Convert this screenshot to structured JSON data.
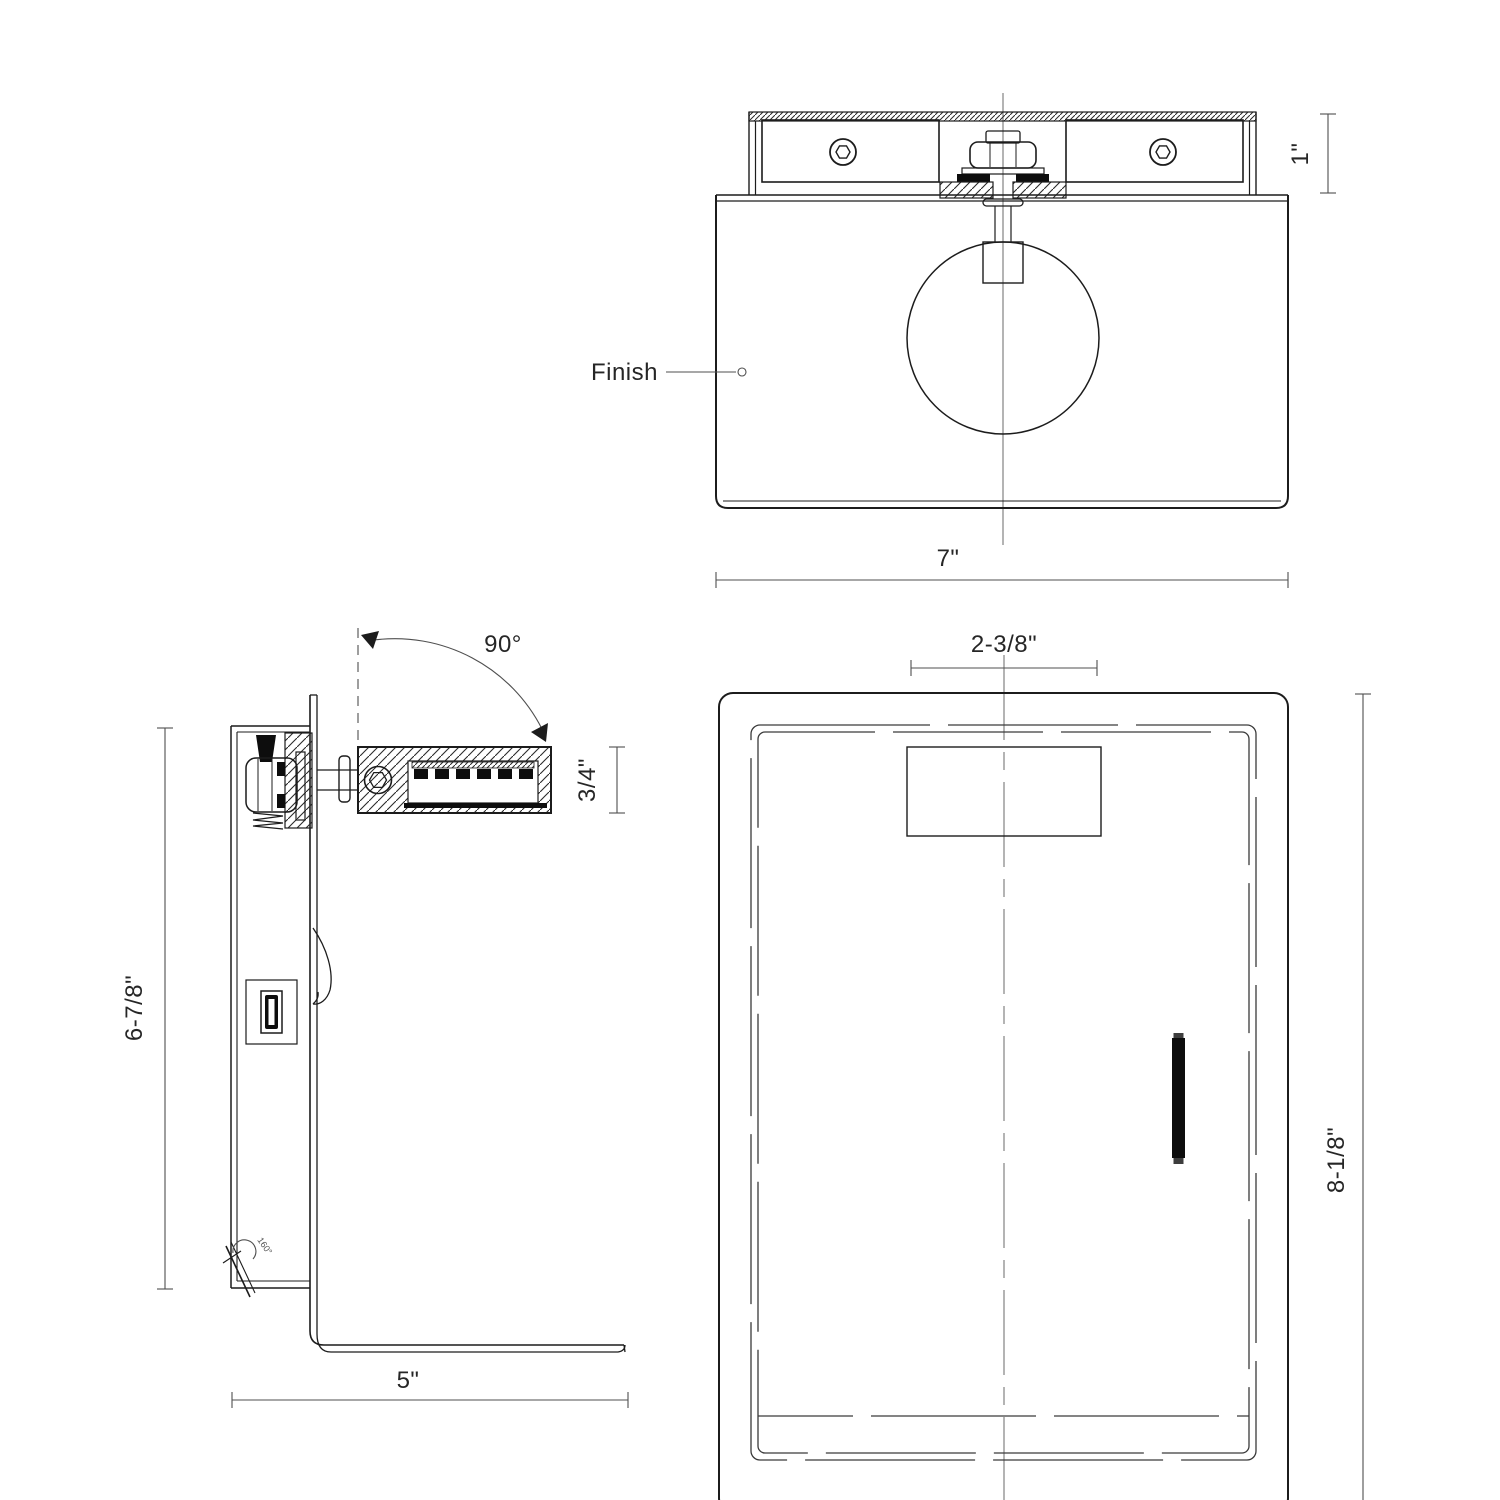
{
  "drawing": {
    "type": "technical-spec-line-drawing",
    "views": [
      "front-view",
      "side-view",
      "rear-view"
    ]
  },
  "labels": {
    "finish": "Finish",
    "front_width": "7\"",
    "front_bracket_height": "1\"",
    "side_rotation": "90°",
    "side_arm_thickness": "3/4\"",
    "side_height": "6-7/8\"",
    "side_depth": "5\"",
    "side_latch_angle": "160°",
    "rear_mount_spacing": "2-3/8\"",
    "rear_height": "8-1/8\""
  },
  "colors": {
    "background": "#ffffff",
    "object_line": "#1c1c1c",
    "dimension_line": "#4f4f4f",
    "center_line": "#6a6a6a",
    "text": "#262626",
    "solid_fill": "#0d0d0d"
  }
}
